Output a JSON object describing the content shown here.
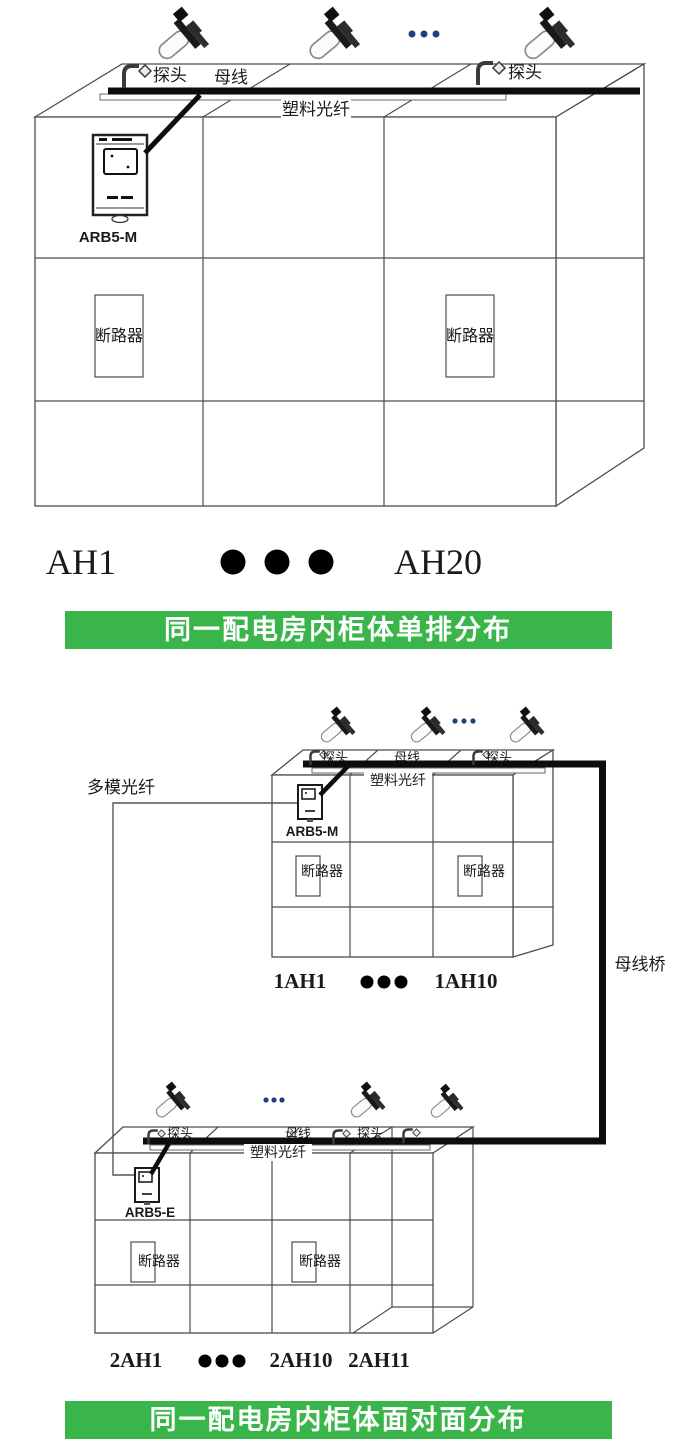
{
  "colors": {
    "banner_green": "#3ab54a",
    "device_label_blue": "#2e56ac",
    "device_label_navy": "#1f3864",
    "busbar_black": "#0d0d0d",
    "dots_blue": "#1e3f7f"
  },
  "figure1": {
    "probe_left_label": "探头",
    "busbar_label": "母线",
    "probe_right_label": "探头",
    "plastic_fiber_label": "塑料光纤",
    "device_label": "ARB5-M",
    "breaker_left_label": "断路器",
    "breaker_right_label": "断路器",
    "cabinet_first_label": "AH1",
    "cabinet_last_label": "AH20",
    "banner_text": "同一配电房内柜体单排分布"
  },
  "figure2_upper": {
    "probe_left_label": "探头",
    "busbar_label": "母线",
    "probe_right_label": "探头",
    "plastic_fiber_label": "塑料光纤",
    "device_label": "ARB5-M",
    "breaker_left_label": "断路器",
    "breaker_right_label": "断路器",
    "cabinet_first_label": "1AH1",
    "cabinet_last_label": "1AH10"
  },
  "figure2_lower": {
    "probe_left_label": "探头",
    "busbar_label": "母线",
    "probe_right_label": "探头",
    "plastic_fiber_label": "塑料光纤",
    "device_label": "ARB5-E",
    "breaker_left_label": "断路器",
    "breaker_right_label": "断路器",
    "cabinet_first_label": "2AH1",
    "cabinet_mid_label": "2AH10",
    "cabinet_last_label": "2AH11"
  },
  "figure2": {
    "multimode_fiber_label": "多模光纤",
    "busbar_bridge_label": "母线桥",
    "banner_text": "同一配电房内柜体面对面分布"
  }
}
